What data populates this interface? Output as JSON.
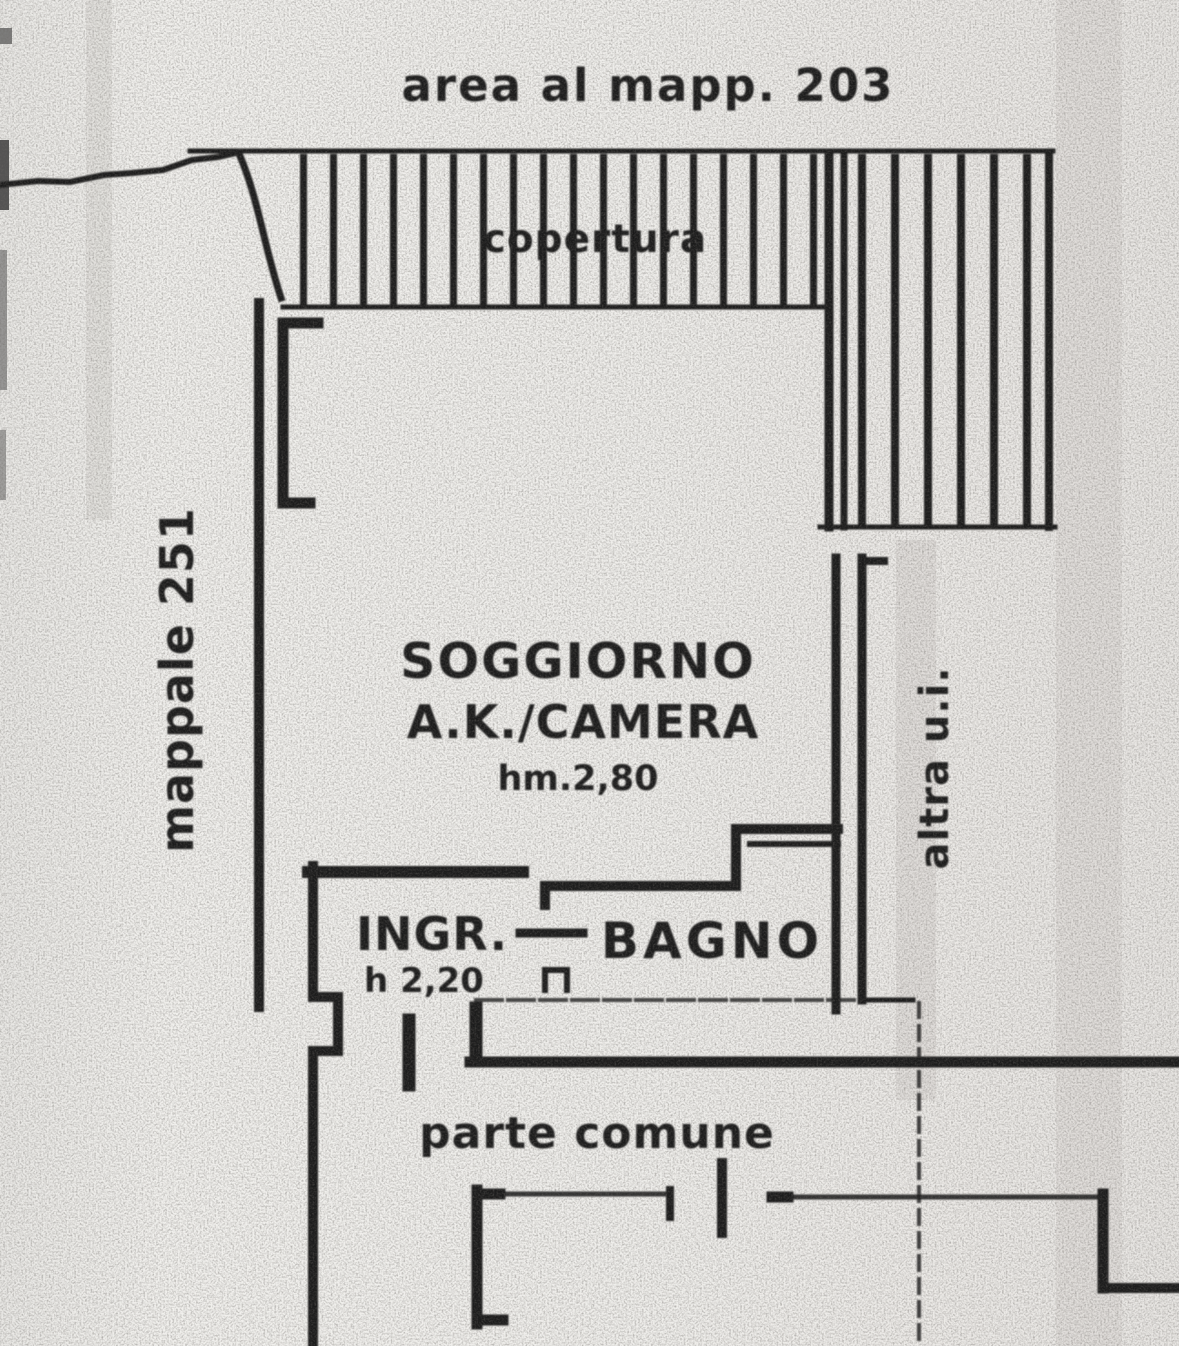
{
  "plan": {
    "top_label": "area al mapp. 203",
    "roof_label": "copertura",
    "left_boundary_label": "mappale 251",
    "main_room": {
      "name_line1": "SOGGIORNO",
      "name_line2": "A.K./CAMERA",
      "height": "hm.2,80"
    },
    "entrance": {
      "name": "INGR.",
      "height": "h 2,20"
    },
    "bathroom": {
      "name": "BAGNO"
    },
    "right_boundary_label": "altra u.i.",
    "common_area_label": "parte comune"
  },
  "colors": {
    "paper": "#eeede9",
    "ink": "#1c1c1c"
  }
}
